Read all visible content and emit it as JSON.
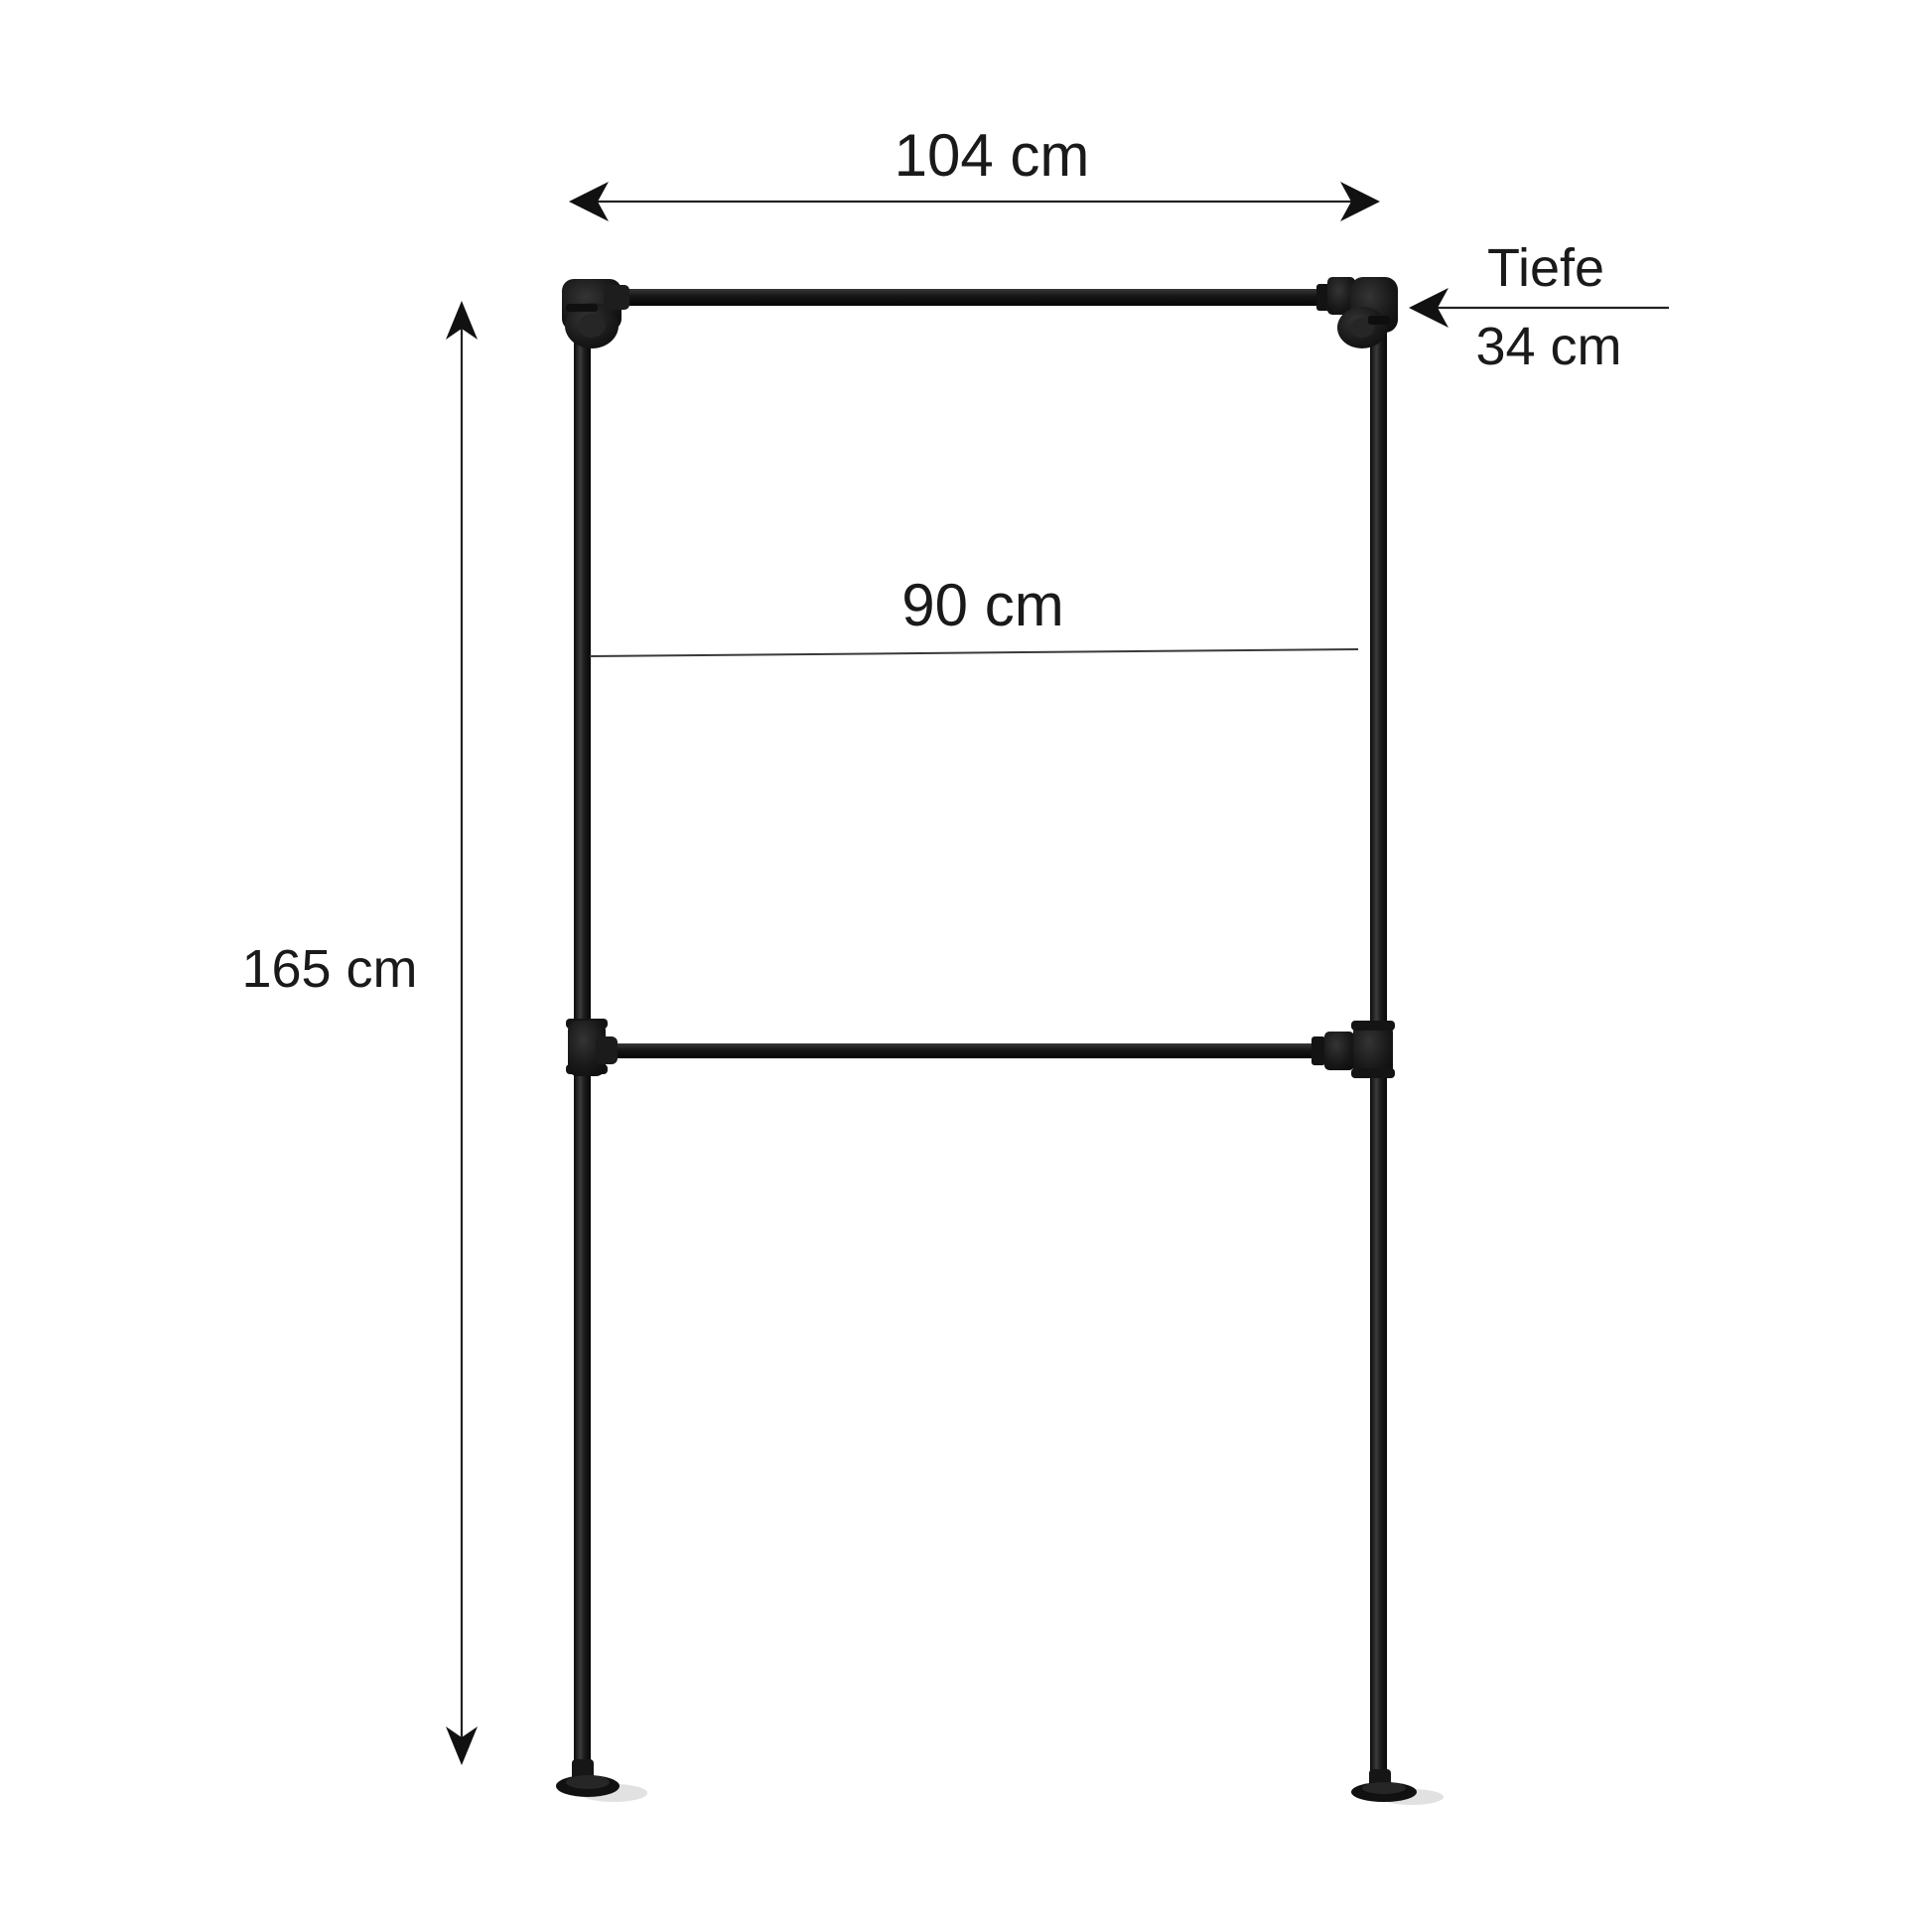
{
  "page": {
    "background": "#ffffff"
  },
  "product_diagram": {
    "subject": "industrial-pipe-clothes-rack",
    "dimensions": {
      "outer_width": {
        "label": "104 cm"
      },
      "inner_width": {
        "label": "90 cm"
      },
      "height": {
        "label": "165 cm"
      },
      "depth": {
        "label": "Tiefe",
        "value": "34 cm"
      }
    },
    "colors": {
      "pipe_dark": "#0d0d0d",
      "pipe_mid": "#2e2e2e",
      "pipe_highlight": "#474747",
      "fitting": "#161616",
      "dimension_line": "#222222",
      "label_text": "#1a1a1a",
      "floor_shadow": "#d9d9d9"
    }
  }
}
